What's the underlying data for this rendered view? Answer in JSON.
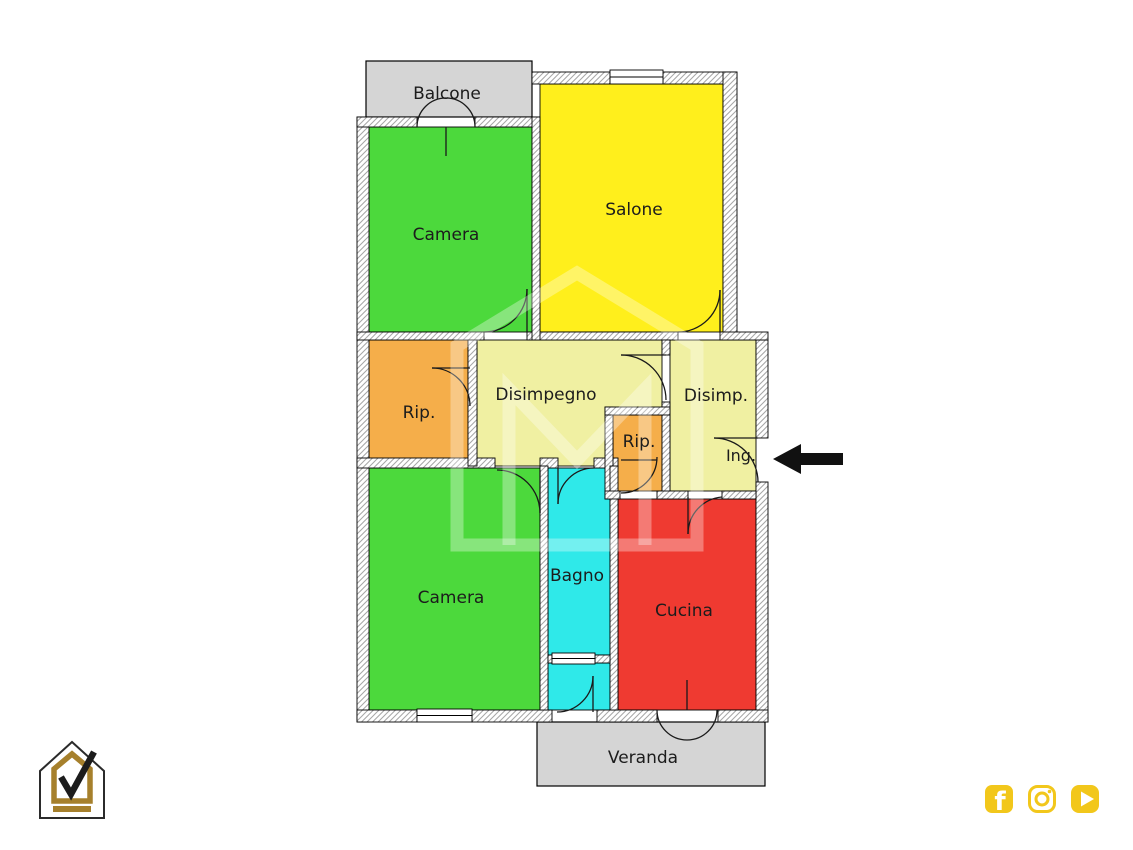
{
  "palette": {
    "wall_outline": "#000000",
    "wall_hatch": "#a6a6a6",
    "label_color": "#1c1c1c",
    "arrow_black": "#111111",
    "watermark_white": "#ffffff",
    "balcony_gray": "#d5d5d5",
    "social_gold": "#f2c71b",
    "logo_gold": "#a6802c"
  },
  "floorplan": {
    "rooms": [
      {
        "id": "balcone",
        "label": "Balcone",
        "color": "#d5d5d5"
      },
      {
        "id": "camera-top",
        "label": "Camera",
        "color": "#4cd93c"
      },
      {
        "id": "salone",
        "label": "Salone",
        "color": "#ffef1c"
      },
      {
        "id": "rip-left",
        "label": "Rip.",
        "color": "#f5ae4a"
      },
      {
        "id": "disimpegno",
        "label": "Disimpegno",
        "color": "#f0f0a2"
      },
      {
        "id": "disimp",
        "label": "Disimp.",
        "color": "#f0f0a2"
      },
      {
        "id": "rip-small",
        "label": "Rip.",
        "color": "#f5ae4a"
      },
      {
        "id": "ing",
        "label": "Ing.",
        "color": "#f0f0a2"
      },
      {
        "id": "camera-bottom",
        "label": "Camera",
        "color": "#4cd93c"
      },
      {
        "id": "bagno",
        "label": "Bagno",
        "color": "#2fe9e9"
      },
      {
        "id": "cucina",
        "label": "Cucina",
        "color": "#ef3a31"
      },
      {
        "id": "veranda",
        "label": "Veranda",
        "color": "#d5d5d5"
      }
    ],
    "entrance_arrow": {
      "direction": "left",
      "points_at": "ing"
    }
  },
  "branding": {
    "logo": "house-checkmark-logo",
    "social_icons": [
      "facebook",
      "instagram",
      "youtube"
    ]
  }
}
